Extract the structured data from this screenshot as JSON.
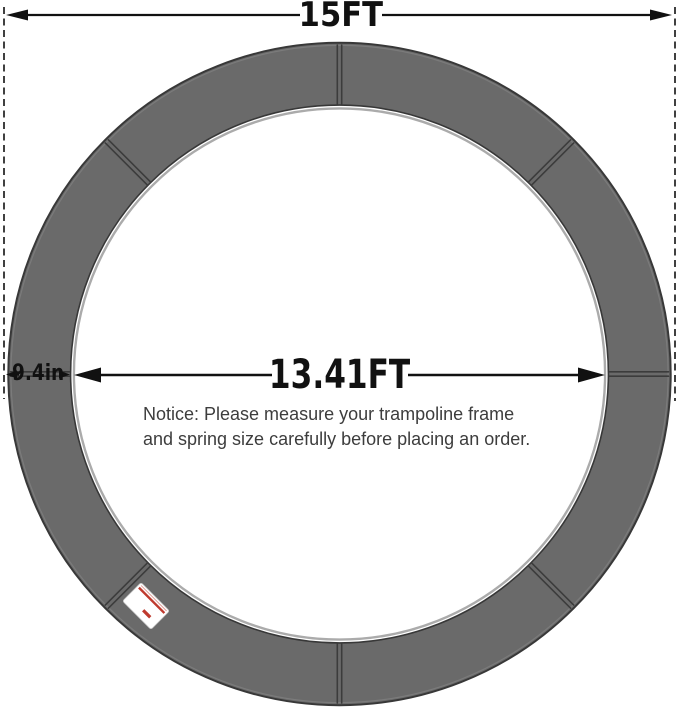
{
  "measurements": {
    "outer_diameter_label": "15FT",
    "inner_diameter_label": "13.41FT",
    "pad_width_label": "9.4in"
  },
  "notice": {
    "line1": "Notice: Please measure your trampoline frame",
    "line2": "and spring size carefully before placing an order."
  },
  "ring": {
    "segment_seams": 8,
    "brand_tag_present": true
  },
  "colors": {
    "background": "#ffffff",
    "pad_fill": "#6a6a6a",
    "pad_outline": "#383838",
    "pad_outer_highlight": "#7b7b7b",
    "seam": "#3c3c3c",
    "inner_edge_highlight": "#ababab",
    "dimension_ink": "#111111",
    "notice_text": "#3d3d3d",
    "label_background": "#ffffff",
    "label_accent": "#bf3a2e"
  }
}
